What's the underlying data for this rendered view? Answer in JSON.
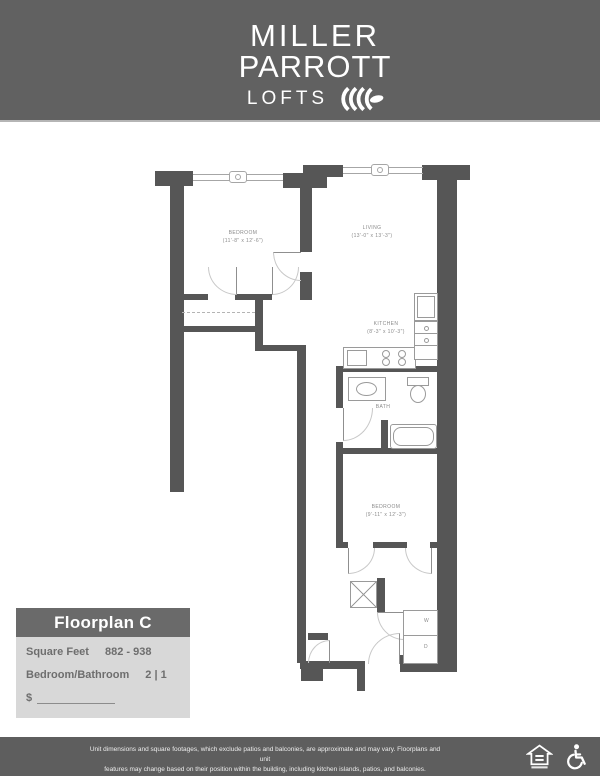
{
  "logo": {
    "line1": "MILLER",
    "line2": "PARROTT",
    "line3": "LOFTS"
  },
  "plan": {
    "rooms": {
      "bedroom1": {
        "name": "BEDROOM",
        "dims": "(11'-8\" x 12'-6\")"
      },
      "living": {
        "name": "LIVING",
        "dims": "(13'-0\" x 13'-3\")"
      },
      "kitchen": {
        "name": "KITCHEN",
        "dims": "(8'-3\" x 10'-3\")"
      },
      "bath": {
        "name": "BATH"
      },
      "bedroom2": {
        "name": "BEDROOM",
        "dims": "(9'-11\" x 12'-3\")"
      },
      "laundry": {
        "washer": "W",
        "dryer": "D"
      }
    }
  },
  "info_box": {
    "title": "Floorplan C",
    "rows": [
      {
        "label": "Square Feet",
        "value": "882 - 938"
      },
      {
        "label": "Bedroom/Bathroom",
        "value": "2 | 1"
      }
    ],
    "price_prefix": "$"
  },
  "footer": {
    "disclaimer_line1": "Unit dimensions and square footages, which exclude patios and balconies, are approximate and may vary. Floorplans and unit",
    "disclaimer_line2": "features may change based on their position within the building, including kitchen islands, patios, and balconies.",
    "icon_names": [
      "equal-housing-icon",
      "accessibility-icon"
    ]
  },
  "colors": {
    "header_bg": "#616161",
    "wall": "#565656",
    "info_header_bg": "#6a6a6a",
    "info_body_bg": "#d8d8d8",
    "footer_bg": "#5e5e5e"
  }
}
